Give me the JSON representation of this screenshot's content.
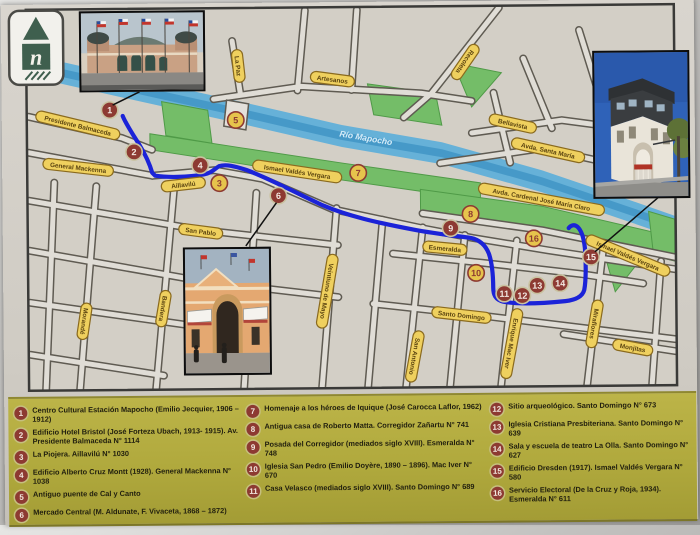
{
  "logo": {
    "letter": "n"
  },
  "map": {
    "colors": {
      "base": "#d3cfc6",
      "street": "#e0ddd6",
      "casing": "#5f5b52",
      "river": "#66b1d8",
      "river_dark": "#3e93c4",
      "park": "#74bd68",
      "pill_fill": "#efd05e",
      "pill_border": "#8a6a1e",
      "pill_text": "#5b4410",
      "route": "#1b23d8",
      "marker_maroon": "#8d3a32",
      "marker_yellow": "#e6c44c"
    },
    "street_labels": [
      {
        "t": "Presidente Balmaceda",
        "x": 76,
        "y": 121,
        "r": 14
      },
      {
        "t": "General Mackenna",
        "x": 76,
        "y": 163,
        "r": 7
      },
      {
        "t": "Aillavilú",
        "x": 181,
        "y": 181,
        "r": -6
      },
      {
        "t": "La Paz",
        "x": 237,
        "y": 63,
        "r": 84
      },
      {
        "t": "Artesanos",
        "x": 331,
        "y": 77,
        "r": 8
      },
      {
        "t": "Ismael Valdés Vergara",
        "x": 295,
        "y": 169,
        "r": 9
      },
      {
        "t": "Recoleta",
        "x": 464,
        "y": 61,
        "r": 125
      },
      {
        "t": "Bellavista",
        "x": 511,
        "y": 123,
        "r": 13
      },
      {
        "t": "Avda. Santa María",
        "x": 546,
        "y": 150,
        "r": 13
      },
      {
        "t": "Avda. Cardenal José María Claro",
        "x": 539,
        "y": 199,
        "r": 11
      },
      {
        "t": "San Pablo",
        "x": 198,
        "y": 228,
        "r": 8
      },
      {
        "t": "Morandé",
        "x": 81,
        "y": 317,
        "r": 99
      },
      {
        "t": "Bandera",
        "x": 160,
        "y": 305,
        "r": 100
      },
      {
        "t": "Veintiuno de Mayo",
        "x": 324,
        "y": 289,
        "r": 100
      },
      {
        "t": "Esmeralda",
        "x": 442,
        "y": 247,
        "r": 6
      },
      {
        "t": "Santo Domingo",
        "x": 458,
        "y": 314,
        "r": 7
      },
      {
        "t": "Enrique Mac Iver",
        "x": 508,
        "y": 343,
        "r": 101
      },
      {
        "t": "San Antonio",
        "x": 411,
        "y": 355,
        "r": 101
      },
      {
        "t": "Miraflores",
        "x": 591,
        "y": 324,
        "r": 100
      },
      {
        "t": "Monjitas",
        "x": 629,
        "y": 348,
        "r": 11
      },
      {
        "t": "Ismael Valdés Vergara",
        "x": 625,
        "y": 256,
        "r": 23
      },
      {
        "t": "Río Mapocho",
        "x": 364,
        "y": 136,
        "r": 10,
        "type": "water"
      }
    ],
    "markers": [
      {
        "n": 1,
        "x": 108,
        "y": 106,
        "s": "m"
      },
      {
        "n": 2,
        "x": 132,
        "y": 148,
        "s": "m"
      },
      {
        "n": 3,
        "x": 217,
        "y": 180,
        "s": "y"
      },
      {
        "n": 4,
        "x": 198,
        "y": 162,
        "s": "m"
      },
      {
        "n": 5,
        "x": 234,
        "y": 117,
        "s": "y"
      },
      {
        "n": 6,
        "x": 276,
        "y": 193,
        "s": "m"
      },
      {
        "n": 7,
        "x": 356,
        "y": 171,
        "s": "y"
      },
      {
        "n": 8,
        "x": 468,
        "y": 213,
        "s": "y"
      },
      {
        "n": 9,
        "x": 448,
        "y": 227,
        "s": "m"
      },
      {
        "n": 10,
        "x": 473,
        "y": 272,
        "s": "y"
      },
      {
        "n": 11,
        "x": 501,
        "y": 293,
        "s": "m"
      },
      {
        "n": 12,
        "x": 519,
        "y": 295,
        "s": "m"
      },
      {
        "n": 13,
        "x": 534,
        "y": 285,
        "s": "m"
      },
      {
        "n": 14,
        "x": 557,
        "y": 283,
        "s": "m"
      },
      {
        "n": 15,
        "x": 588,
        "y": 257,
        "s": "m"
      },
      {
        "n": 16,
        "x": 531,
        "y": 238,
        "s": "y"
      }
    ]
  },
  "legend": {
    "columns": [
      {
        "left": 6,
        "width": 226,
        "items": [
          {
            "num": "1",
            "text": "Centro Cultural Estación Mapocho (Emilio Jecquier, 1906 – 1912)"
          },
          {
            "num": "2",
            "text": "Edificio Hotel Bristol (José Forteza Ubach, 1913- 1915). Av. Presidente Balmaceda N° 1114"
          },
          {
            "num": "3",
            "text": "La Piojera. Aillavilú N° 1030"
          },
          {
            "num": "4",
            "text": "Edificio Alberto Cruz Montt (1928). General Mackenna N° 1038"
          },
          {
            "num": "5",
            "text": "Antiguo puente de Cal y Canto"
          },
          {
            "num": "6",
            "text": "Mercado Central (M. Aldunate, F. Vivaceta, 1868 – 1872)"
          }
        ]
      },
      {
        "left": 238,
        "width": 236,
        "items": [
          {
            "num": "7",
            "text": "Homenaje a los héroes de Iquique (José Carocca Laflor, 1962)"
          },
          {
            "num": "8",
            "text": "Antigua casa de Roberto Matta. Corregidor Zañartu N° 741"
          },
          {
            "num": "9",
            "text": "Posada del Corregidor (mediados siglo XVIII). Esmeralda N° 748"
          },
          {
            "num": "10",
            "text": "Iglesia San Pedro (Emilio Doyère, 1890 – 1896). Mac Iver N° 670"
          },
          {
            "num": "11",
            "text": "Casa Velasco (mediados siglo XVIII). Santo Domingo N° 689"
          }
        ]
      },
      {
        "left": 482,
        "width": 204,
        "items": [
          {
            "num": "12",
            "text": "Sitio arqueológico. Santo Domingo N° 673"
          },
          {
            "num": "13",
            "text": "Iglesia Cristiana Presbiteriana. Santo Domingo N° 639"
          },
          {
            "num": "14",
            "text": "Sala y escuela de teatro La Olla. Santo Domingo N° 627"
          },
          {
            "num": "15",
            "text": "Edificio Dresden (1917). Ismael Valdés Vergara N° 580"
          },
          {
            "num": "16",
            "text": "Servicio Electoral (De la Cruz y Roja, 1934). Esmeralda N° 611"
          }
        ]
      }
    ]
  }
}
